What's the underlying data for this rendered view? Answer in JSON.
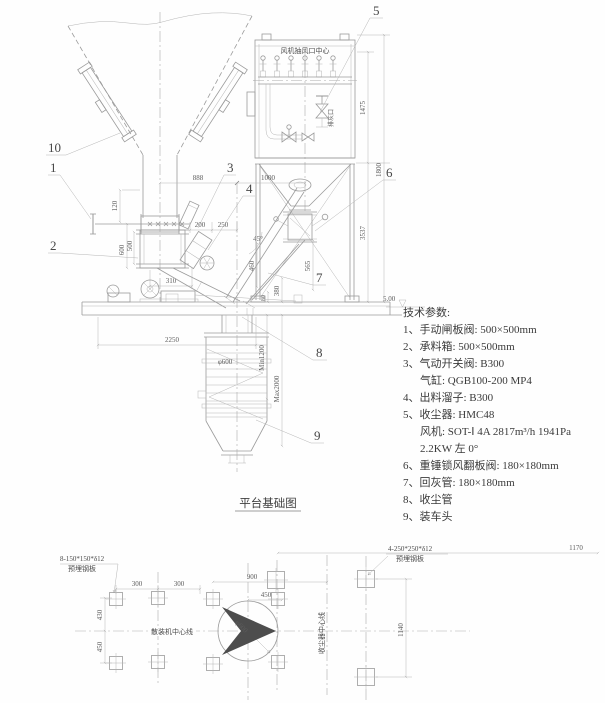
{
  "elevation": {
    "labels": {
      "n1": "1",
      "n2": "2",
      "n3": "3",
      "n4": "4",
      "n5": "5",
      "n6": "6",
      "n7": "7",
      "n8": "8",
      "n9": "9",
      "n10": "10"
    },
    "dims": {
      "w888": "888",
      "w1000": "1000",
      "h120": "120",
      "h600": "600",
      "h500": "500",
      "w310": "310",
      "w200": "200",
      "w250": "250",
      "a45": "45°",
      "h460": "460",
      "h380": "380",
      "h80": "80",
      "h565": "565",
      "w2250": "2250",
      "h1475": "1475",
      "h3537": "3537",
      "h1800": "1800",
      "min": "Min1200",
      "max": "Max2000",
      "phi": "φ600"
    },
    "texts": {
      "fan_center": "风机抽风口中心",
      "ash_port": "排灰口",
      "level": "5.00"
    }
  },
  "tech": {
    "title": "技术参数:",
    "lines": [
      "1、手动闸板阀: 500×500mm",
      "2、承料箱: 500×500mm",
      "3、气动开关阀: B300",
      "气缸: QGB100-200 MP4",
      "4、出料溜子: B300",
      "5、收尘器: HMC48",
      "风机: SOT-Ⅰ 4A 2817m³/h 1941Pa",
      "2.2KW 左 0°",
      "6、重锤锁风翻板阀: 180×180mm",
      "7、回灰管: 180×180mm",
      "8、收尘管",
      "9、装车头"
    ]
  },
  "caption": "平台基础图",
  "plan": {
    "notes": {
      "left1": "8-150*150*δ12",
      "left2": "预埋钢板",
      "right1": "4-250*250*δ12",
      "right2": "预埋钢板"
    },
    "centerlines": {
      "h": "散装机中心线",
      "v": "收尘器中心线"
    },
    "dims": {
      "w300a": "300",
      "w300b": "300",
      "h430": "430",
      "h450": "450",
      "w900": "900",
      "w450": "450",
      "w1170": "1170",
      "h1140": "1140",
      "phi": "φ600"
    }
  }
}
